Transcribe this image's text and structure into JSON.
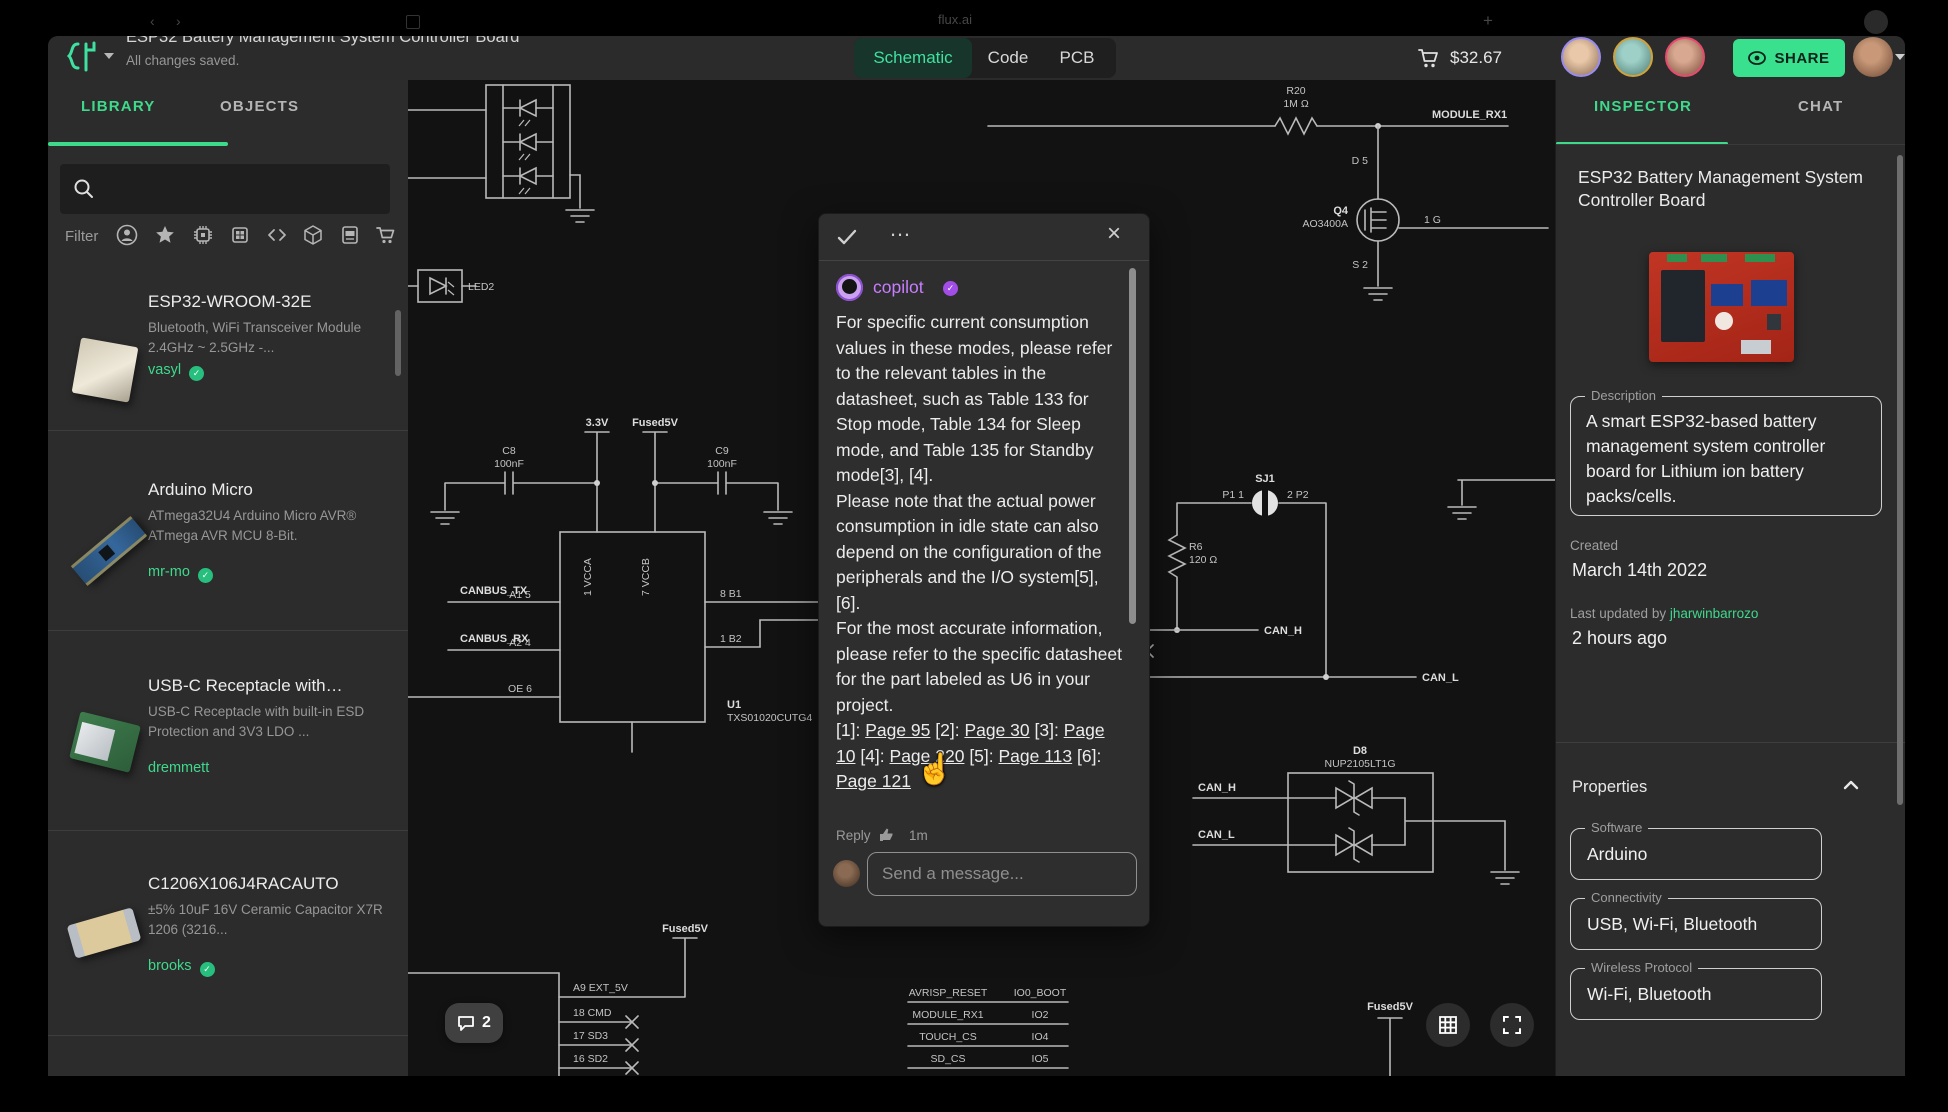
{
  "chrome": {
    "tab_title": "flux.ai",
    "new_tab": "+",
    "back": "‹",
    "forward": "›"
  },
  "header": {
    "window_title": "ESP32 Battery Management System Controller Board",
    "saved_status": "All changes saved.",
    "tab_schematic": "Schematic",
    "tab_code": "Code",
    "tab_pcb": "PCB",
    "cart_total": "$32.67",
    "share_label": "SHARE"
  },
  "library": {
    "tab_library": "LIBRARY",
    "tab_objects": "OBJECTS",
    "filter_label": "Filter",
    "items": [
      {
        "title": "ESP32-WROOM-32E",
        "desc": "Bluetooth, WiFi Transceiver Module 2.4GHz ~ 2.5GHz -...",
        "author": "vasyl"
      },
      {
        "title": "Arduino Micro",
        "desc": "ATmega32U4 Arduino Micro AVR® ATmega AVR MCU 8-Bit.",
        "author": "mr-mo"
      },
      {
        "title": "USB-C Receptacle with…",
        "desc": "USB-C Receptacle with built-in ESD Protection and 3V3 LDO ...",
        "author": "dremmett"
      },
      {
        "title": "C1206X106J4RACAUTO",
        "desc": "±5% 10uF 16V Ceramic Capacitor X7R 1206 (3216...",
        "author": "brooks"
      }
    ]
  },
  "popup": {
    "author": "copilot",
    "p1": "For specific current consumption values in these modes, please refer to the relevant tables in the datasheet, such as Table 133 for Stop mode, Table 134 for Sleep mode, and Table 135 for Standby mode[3], [4].",
    "p2": "Please note that the actual power consumption in idle state can also depend on the configuration of the peripherals and the I/O system[5], [6].",
    "p3": "For the most accurate information, please refer to the specific datasheet for the part labeled as U6 in your project.",
    "refs": [
      {
        "pre": "[1]: ",
        "link": "Page 95"
      },
      {
        "pre": " [2]: ",
        "link": "Page 30"
      },
      {
        "pre": " [3]: ",
        "link": "Page 10"
      },
      {
        "pre": " [4]: ",
        "link": "Page 220"
      },
      {
        "pre": " [5]: ",
        "link": "Page 113"
      },
      {
        "pre": " [6]: ",
        "link": "Page 121"
      }
    ],
    "reply_label": "Reply",
    "time": "1m",
    "menu": "…",
    "close": "×",
    "input_placeholder": "Send a message..."
  },
  "inspector": {
    "tab_inspector": "INSPECTOR",
    "tab_chat": "CHAT",
    "title": "ESP32 Battery Management System Controller Board",
    "description_label": "Description",
    "description": "A smart ESP32-based battery management system controller board for Lithium ion battery packs/cells.",
    "created_label": "Created",
    "created_value": "March 14th 2022",
    "updated_label": "Last updated by",
    "updated_by": "jharwinbarrozo",
    "updated_value": "2 hours ago",
    "properties_label": "Properties",
    "fields": [
      {
        "label": "Software",
        "value": "Arduino"
      },
      {
        "label": "Connectivity",
        "value": "USB, Wi-Fi, Bluetooth"
      },
      {
        "label": "Wireless Protocol",
        "value": "Wi-Fi, Bluetooth"
      }
    ]
  },
  "canvas": {
    "comment_count": "2",
    "labels": {
      "led2": "LED2",
      "r20": "R20",
      "r20v": "1M Ω",
      "module_rx1": "MODULE_RX1",
      "d5": "D 5",
      "q4": "Q4",
      "q4p": "AO3400A",
      "g1": "1 G",
      "s2": "S 2",
      "v33": "3.3V",
      "f5v1": "Fused5V",
      "c8": "C8",
      "c8v": "100nF",
      "c9": "C9",
      "c9v": "100nF",
      "vcca": "1 VCCA",
      "vccb": "7 VCCB",
      "ctx": "CANBUS_TX",
      "a15": "A1 5",
      "crx": "CANBUS_RX",
      "a24": "A2 4",
      "oe6": "OE 6",
      "b18": "8 B1",
      "b21": "1 B2",
      "u1": "U1",
      "u1p": "TXS01020CUTG4",
      "sj1": "SJ1",
      "p11": "P1 1",
      "p22": "2 P2",
      "r6": "R6",
      "r6v": "120 Ω",
      "canh": "CAN_H",
      "canl": "CAN_L",
      "d8": "D8",
      "d8p": "NUP2105LT1G",
      "canh2": "CAN_H",
      "canl2": "CAN_L",
      "f5v2": "Fused5V",
      "f5v3": "Fused5V",
      "ext5v": "A9 EXT_5V",
      "cmd": "18 CMD",
      "sd3": "17 SD3",
      "sd2": "16 SD2",
      "t0l": "AVRISP_RESET",
      "t0r": "IO0_BOOT",
      "t1l": "MODULE_RX1",
      "t1r": "IO2",
      "t2l": "TOUCH_CS",
      "t2r": "IO4",
      "t3l": "SD_CS",
      "t3r": "IO5"
    }
  },
  "colors": {
    "accent": "#3fe0a0",
    "share_green": "#39e08e",
    "copilot_purple": "#c77dff",
    "canvas_bg": "#121212"
  }
}
